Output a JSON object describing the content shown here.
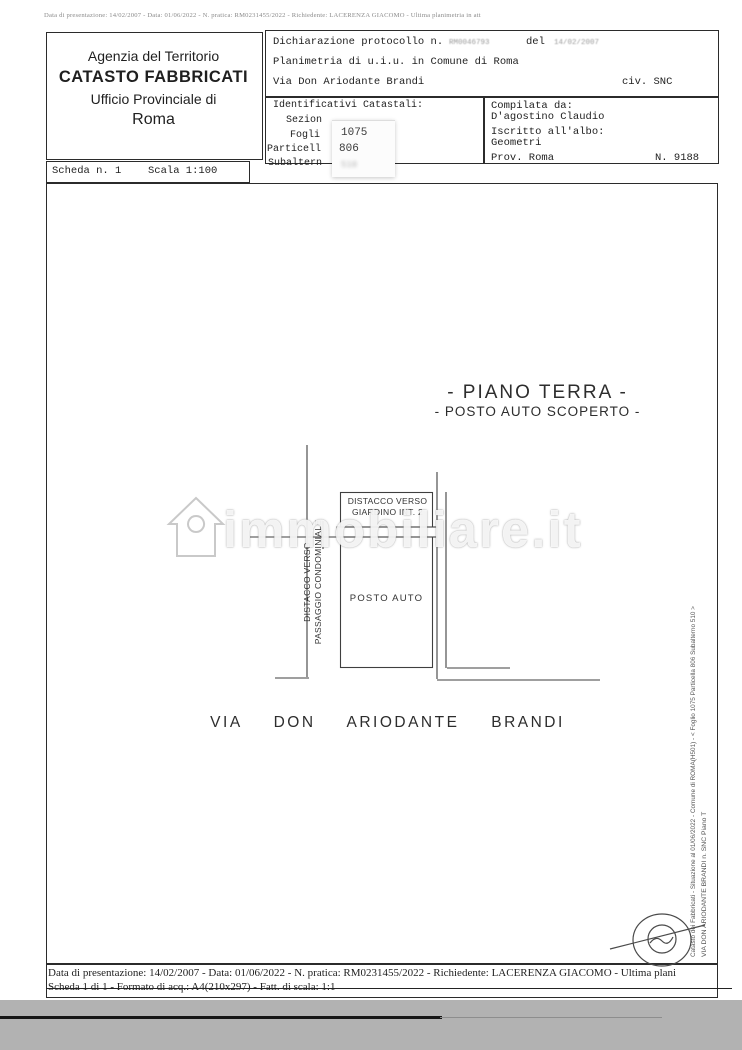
{
  "colors": {
    "paper": "#ffffff",
    "ink": "#1f1f1f",
    "scan_gray": "#b2b2b2",
    "faint_value": "#9a9a9a"
  },
  "page": {
    "top_strip": "Data di presentazione: 14/02/2007 - Data: 01/06/2022 - N. pratica: RM0231455/2022 - Richiedente: LACERENZA GIACOMO - Ultima planimetria in att"
  },
  "header": {
    "agency": {
      "line1": "Agenzia del Territorio",
      "line2": "CATASTO FABBRICATI",
      "line3": "Ufficio Provinciale di",
      "line4": "Roma"
    },
    "declaration": {
      "label": "Dichiarazione protocollo n.",
      "protocol_value": "RM0046793",
      "del_label": "del",
      "del_value": "14/02/2007",
      "line2": "Planimetria di u.i.u. in Comune di Roma",
      "street": "Via Don Ariodante Brandi",
      "civ": "civ. SNC"
    },
    "identifiers": {
      "title": "Identificativi Catastali:",
      "rows": [
        {
          "label": "Sezion",
          "value": ""
        },
        {
          "label": "Fogli",
          "value": "1075"
        },
        {
          "label": "Particell",
          "value": "806"
        },
        {
          "label": "Subaltern",
          "value": "510"
        }
      ]
    },
    "compiled": {
      "label": "Compilata da:",
      "name": "D'agostino Claudio",
      "albo_label": "Iscritto all'albo:",
      "albo_value": "Geometri",
      "prov_label": "Prov. Roma",
      "number": "N. 9188"
    },
    "scheda_bar": {
      "scheda": "Scheda n. 1",
      "scala": "Scala 1:100"
    }
  },
  "plan": {
    "title_line1": "- PIANO TERRA -",
    "title_line2": "- POSTO AUTO SCOPERTO -",
    "giardino_line1": "DISTACCO VERSO",
    "giardino_line2": "GIARDINO INT. 2",
    "posto_auto": "POSTO AUTO",
    "passaggio_line1": "DISTACCO VERSO",
    "passaggio_line2": "PASSAGGIO CONDOMINIALE",
    "street": "VIA DON ARIODANTE BRANDI",
    "side_text1": "Catasto dei Fabbricati - Situazione al 01/06/2022 - Comune di ROMA(H501) - < Foglio 1075 Particella 806 Subalterno 510 >",
    "side_text2": "VIA DON ARIODANTE BRANDI n. SNC Piano T"
  },
  "watermark": {
    "text": "immobiliare.it"
  },
  "footer": {
    "line1": "Data di presentazione: 14/02/2007 - Data: 01/06/2022 - N. pratica: RM0231455/2022 - Richiedente: LACERENZA GIACOMO - Ultima plani",
    "line2": "Scheda 1 di 1 - Formato di acq.: A4(210x297) - Fatt. di scala: 1:1"
  }
}
